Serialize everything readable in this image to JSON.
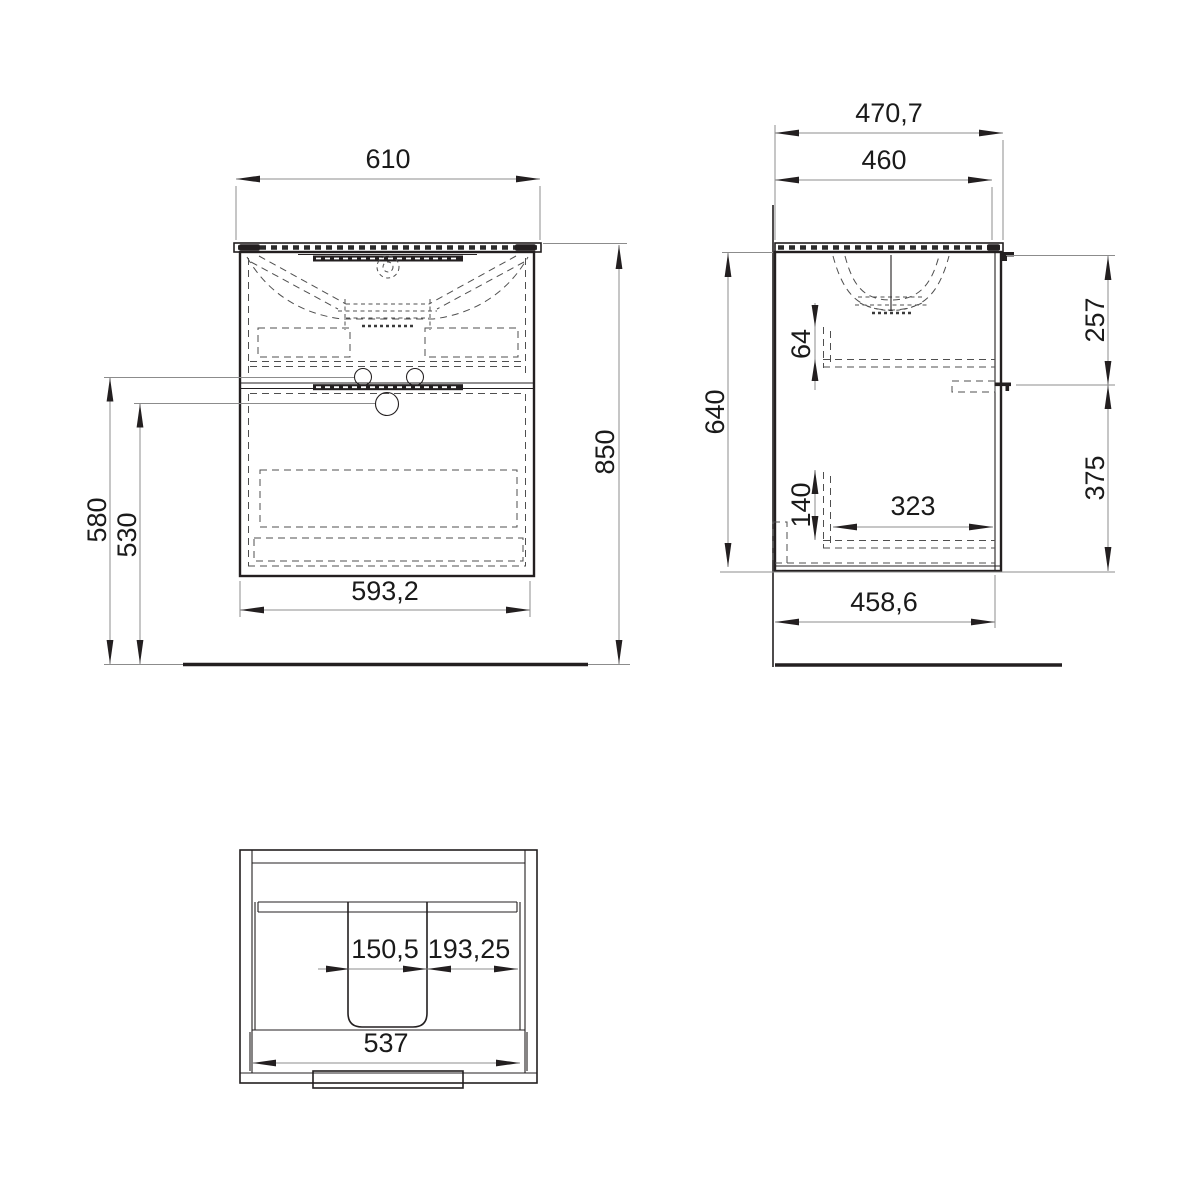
{
  "drawing": {
    "kind": "technical-dimension-drawing",
    "subject": "wall-hung vanity cabinet with washbasin, two drawers",
    "colors": {
      "line": "#231f20",
      "background": "#ffffff",
      "dim_line": "#8c8c8c"
    }
  },
  "views": {
    "front_view": {
      "top_width": "610",
      "bottom_width": "593,2",
      "overall_height": "850",
      "left_outer_height": "580",
      "left_inner_height": "530"
    },
    "side_view": {
      "overall_depth": "470,7",
      "top_depth": "460",
      "carcass_height": "640",
      "upper_inner_offset": "64",
      "lower_inner_offset": "140",
      "inner_depth": "323",
      "upper_front_height": "257",
      "lower_front_height": "375",
      "bottom_depth": "458,6"
    },
    "top_view": {
      "cutout_width": "150,5",
      "cutout_to_side": "193,25",
      "inner_width": "537"
    }
  }
}
